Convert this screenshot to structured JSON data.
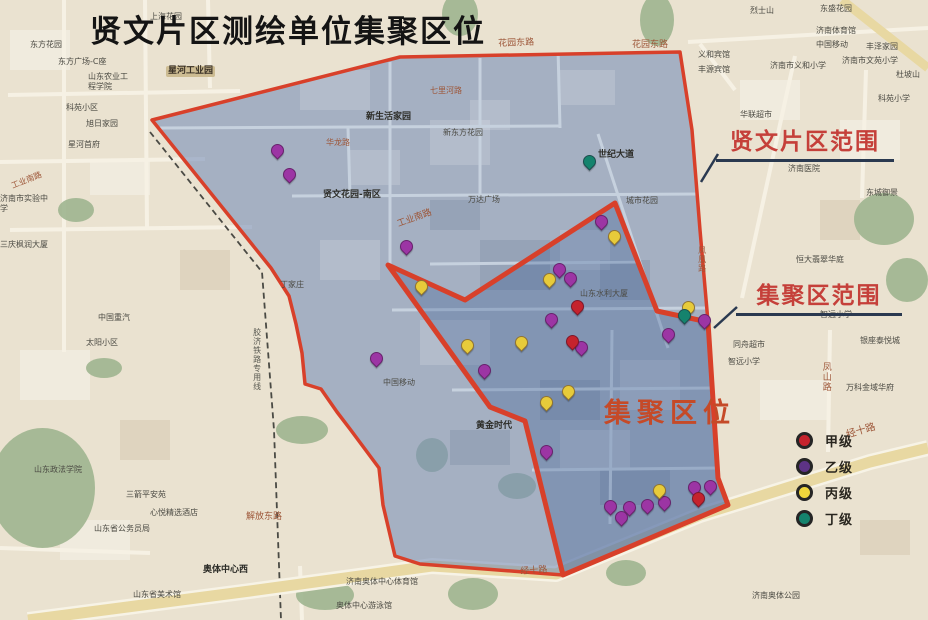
{
  "title": "贤文片区测绘单位集聚区位",
  "callouts": {
    "region": "贤文片区范围",
    "cluster": "集聚区范围",
    "cluster_area": "集聚区位"
  },
  "legend": {
    "items": [
      {
        "label": "甲级",
        "color": "#c5232d"
      },
      {
        "label": "乙级",
        "color": "#5d3385"
      },
      {
        "label": "丙级",
        "color": "#f0d63c"
      },
      {
        "label": "丁级",
        "color": "#15836d"
      }
    ]
  },
  "colors": {
    "beige": "#eae2d0",
    "region_fill": "rgba(115,140,185,0.58)",
    "cluster_fill": "rgba(50,85,145,0.30)",
    "boundary": "#d8402a",
    "pointer": "#2a3950",
    "road_band": "#e8d8a2",
    "road_casing": "#f7f3e6",
    "white_road": "#f6f1e4",
    "inner_road": "#c6d1de",
    "railway": "#4a4a44",
    "park": "#9fb58f",
    "label": "#4b4a43",
    "label_bold": "#2d2d28",
    "label_road": "#9d5638",
    "marker_border": "rgba(40,10,40,0.45)"
  },
  "marker_colors": {
    "甲": "#c5232d",
    "乙": "#9c35a4",
    "丙": "#e7cb3a",
    "丁": "#15836d"
  },
  "map": {
    "outer_polygon": "152,120 400,57 680,52 692,130 700,230 708,322 718,478 728,505 563,575 420,564 395,556 383,505 379,468 350,429 337,412 321,389 305,384 302,353 296,324 289,296 271,268",
    "inner_polygon": "388,265 465,300 615,203 657,311 708,322 718,478 728,505 563,575 525,421 490,407",
    "jingshi_road": "28,620 250,591 432,566 556,574 700,515 870,462 928,448",
    "yellow_road": "842,0 928,68",
    "railway": "150,132 262,272 274,430 281,620",
    "pointers": [
      {
        "x1": 718,
        "y1": 154,
        "x2": 701,
        "y2": 182
      },
      {
        "x1": 737,
        "y1": 307,
        "x2": 714,
        "y2": 328
      }
    ],
    "white_roads": [
      "64,0 64,352",
      "8,95 240,91",
      "0,162 205,159",
      "10,230 252,227",
      "145,0 147,227",
      "208,0 210,88",
      "688,42 928,28",
      "795,56 742,298",
      "830,330 828,452",
      "866,70 862,198",
      "0,548 150,553",
      "300,566 302,620",
      "735,90 700,44"
    ],
    "inner_roads": [
      "160,128 560,126",
      "292,196 700,194",
      "390,62 390,264",
      "480,58 480,195",
      "558,48 560,128",
      "598,134 668,348",
      "392,310 706,308",
      "452,390 716,388",
      "532,470 720,468",
      "612,330 610,524",
      "348,128 350,196",
      "430,264 640,262"
    ],
    "parks": [
      {
        "x": 640,
        "y": -6,
        "w": 34,
        "h": 52
      },
      {
        "x": 854,
        "y": 193,
        "w": 60,
        "h": 52
      },
      {
        "x": 886,
        "y": 258,
        "w": 42,
        "h": 44
      },
      {
        "x": -10,
        "y": 428,
        "w": 105,
        "h": 120
      },
      {
        "x": 86,
        "y": 358,
        "w": 36,
        "h": 20
      },
      {
        "x": 276,
        "y": 416,
        "w": 52,
        "h": 28
      },
      {
        "x": 296,
        "y": 580,
        "w": 58,
        "h": 30
      },
      {
        "x": 448,
        "y": 578,
        "w": 50,
        "h": 32
      },
      {
        "x": 416,
        "y": 438,
        "w": 32,
        "h": 34
      },
      {
        "x": 498,
        "y": 473,
        "w": 38,
        "h": 26
      },
      {
        "x": 442,
        "y": -8,
        "w": 36,
        "h": 44
      },
      {
        "x": 58,
        "y": 198,
        "w": 36,
        "h": 24
      },
      {
        "x": 606,
        "y": 560,
        "w": 40,
        "h": 26
      }
    ],
    "markers": [
      {
        "g": "乙",
        "x": 277,
        "y": 160
      },
      {
        "g": "乙",
        "x": 289,
        "y": 184
      },
      {
        "g": "乙",
        "x": 406,
        "y": 256
      },
      {
        "g": "乙",
        "x": 376,
        "y": 368
      },
      {
        "g": "乙",
        "x": 484,
        "y": 380
      },
      {
        "g": "乙",
        "x": 551,
        "y": 329
      },
      {
        "g": "乙",
        "x": 559,
        "y": 279
      },
      {
        "g": "乙",
        "x": 570,
        "y": 288
      },
      {
        "g": "乙",
        "x": 601,
        "y": 231
      },
      {
        "g": "乙",
        "x": 668,
        "y": 344
      },
      {
        "g": "乙",
        "x": 581,
        "y": 357
      },
      {
        "g": "乙",
        "x": 546,
        "y": 461
      },
      {
        "g": "乙",
        "x": 610,
        "y": 516
      },
      {
        "g": "乙",
        "x": 629,
        "y": 517
      },
      {
        "g": "乙",
        "x": 647,
        "y": 515
      },
      {
        "g": "乙",
        "x": 664,
        "y": 512
      },
      {
        "g": "乙",
        "x": 694,
        "y": 497
      },
      {
        "g": "乙",
        "x": 710,
        "y": 496
      },
      {
        "g": "乙",
        "x": 621,
        "y": 527
      },
      {
        "g": "乙",
        "x": 704,
        "y": 330
      },
      {
        "g": "丙",
        "x": 421,
        "y": 296
      },
      {
        "g": "丙",
        "x": 467,
        "y": 355
      },
      {
        "g": "丙",
        "x": 521,
        "y": 352
      },
      {
        "g": "丙",
        "x": 549,
        "y": 289
      },
      {
        "g": "丙",
        "x": 614,
        "y": 246
      },
      {
        "g": "丙",
        "x": 568,
        "y": 401
      },
      {
        "g": "丙",
        "x": 546,
        "y": 412
      },
      {
        "g": "丙",
        "x": 659,
        "y": 500
      },
      {
        "g": "丙",
        "x": 688,
        "y": 317
      },
      {
        "g": "丁",
        "x": 589,
        "y": 171
      },
      {
        "g": "丁",
        "x": 684,
        "y": 325
      },
      {
        "g": "甲",
        "x": 577,
        "y": 316
      },
      {
        "g": "甲",
        "x": 572,
        "y": 351
      },
      {
        "g": "甲",
        "x": 698,
        "y": 508
      }
    ],
    "labels": [
      {
        "t": "上海花园",
        "x": 150,
        "y": 12
      },
      {
        "t": "东方花园",
        "x": 30,
        "y": 40
      },
      {
        "t": "东方广场-C座",
        "x": 58,
        "y": 57
      },
      {
        "t": "山东农业工程学院",
        "x": 88,
        "y": 72,
        "w": 42
      },
      {
        "t": "科苑小区",
        "x": 66,
        "y": 103
      },
      {
        "t": "旭日家园",
        "x": 86,
        "y": 119
      },
      {
        "t": "星河首府",
        "x": 68,
        "y": 140
      },
      {
        "t": "星河工业园",
        "x": 166,
        "y": 66,
        "hl": 1,
        "s": 9
      },
      {
        "t": "济南市实验中学",
        "x": 0,
        "y": 194,
        "w": 52
      },
      {
        "t": "工业南路",
        "x": 10,
        "y": 182,
        "r": -22,
        "rd": 1
      },
      {
        "t": "三庆枫润大厦",
        "x": 0,
        "y": 240,
        "w": 50
      },
      {
        "t": "中国重汽",
        "x": 98,
        "y": 313
      },
      {
        "t": "太阳小区",
        "x": 86,
        "y": 338
      },
      {
        "t": "山东政法学院",
        "x": 34,
        "y": 465
      },
      {
        "t": "三箭平安苑",
        "x": 126,
        "y": 490
      },
      {
        "t": "心悦精选酒店",
        "x": 150,
        "y": 508
      },
      {
        "t": "山东省公务员局",
        "x": 94,
        "y": 524
      },
      {
        "t": "解放东路",
        "x": 246,
        "y": 512,
        "rd": 1,
        "s": 9
      },
      {
        "t": "奥体中心西",
        "x": 203,
        "y": 565,
        "b": 1,
        "s": 9
      },
      {
        "t": "山东省美术馆",
        "x": 133,
        "y": 590
      },
      {
        "t": "济南奥体中心体育馆",
        "x": 346,
        "y": 577,
        "w": 78
      },
      {
        "t": "奥体中心游泳馆",
        "x": 336,
        "y": 601
      },
      {
        "t": "经十路",
        "x": 520,
        "y": 567,
        "r": -4,
        "rd": 1,
        "s": 9
      },
      {
        "t": "经十路",
        "x": 845,
        "y": 430,
        "r": -16,
        "rd": 1,
        "s": 10
      },
      {
        "t": "丁家庄",
        "x": 280,
        "y": 280
      },
      {
        "t": "烈士山",
        "x": 750,
        "y": 6
      },
      {
        "t": "东盛花园",
        "x": 820,
        "y": 4
      },
      {
        "t": "济南体育馆",
        "x": 816,
        "y": 26
      },
      {
        "t": "中国移动",
        "x": 816,
        "y": 40
      },
      {
        "t": "济南市义和小学",
        "x": 770,
        "y": 61
      },
      {
        "t": "义和宾馆",
        "x": 698,
        "y": 50
      },
      {
        "t": "丰源宾馆",
        "x": 698,
        "y": 65
      },
      {
        "t": "华联超市",
        "x": 740,
        "y": 110
      },
      {
        "t": "丰泽家园",
        "x": 866,
        "y": 42
      },
      {
        "t": "杜坡山",
        "x": 896,
        "y": 70
      },
      {
        "t": "科苑小学",
        "x": 878,
        "y": 94
      },
      {
        "t": "济南市文苑小学",
        "x": 842,
        "y": 56
      },
      {
        "t": "东城御景",
        "x": 866,
        "y": 188
      },
      {
        "t": "济南医院",
        "x": 788,
        "y": 164
      },
      {
        "t": "恒大翡翠华庭",
        "x": 796,
        "y": 255
      },
      {
        "t": "同舟超市",
        "x": 733,
        "y": 340
      },
      {
        "t": "智远小学",
        "x": 820,
        "y": 310
      },
      {
        "t": "智远小学",
        "x": 728,
        "y": 357
      },
      {
        "t": "银座泰悦城",
        "x": 860,
        "y": 336
      },
      {
        "t": "万科金域华府",
        "x": 846,
        "y": 383
      },
      {
        "t": "凤山路",
        "x": 820,
        "y": 362,
        "vt": 1,
        "rd": 1,
        "s": 9
      },
      {
        "t": "凤凰路",
        "x": 697,
        "y": 246,
        "vt": 1,
        "rd": 1
      },
      {
        "t": "花园东路",
        "x": 498,
        "y": 39,
        "rd": 1,
        "s": 9,
        "r": -2
      },
      {
        "t": "花园东路",
        "x": 632,
        "y": 40,
        "rd": 1,
        "s": 9
      },
      {
        "t": "七里河路",
        "x": 430,
        "y": 86,
        "rd": 1
      },
      {
        "t": "新生活家园",
        "x": 366,
        "y": 112,
        "b": 1,
        "s": 9
      },
      {
        "t": "新东方花园",
        "x": 443,
        "y": 128
      },
      {
        "t": "华龙路",
        "x": 326,
        "y": 138,
        "rd": 1
      },
      {
        "t": "世纪大道",
        "x": 598,
        "y": 150,
        "b": 1,
        "s": 9
      },
      {
        "t": "贤文花园-南区",
        "x": 323,
        "y": 190,
        "b": 1,
        "s": 9
      },
      {
        "t": "工业南路",
        "x": 396,
        "y": 220,
        "r": -20,
        "rd": 1,
        "s": 9
      },
      {
        "t": "万达广场",
        "x": 468,
        "y": 195
      },
      {
        "t": "城市花园",
        "x": 626,
        "y": 196
      },
      {
        "t": "中国移动",
        "x": 383,
        "y": 378
      },
      {
        "t": "山东水利大厦",
        "x": 580,
        "y": 289
      },
      {
        "t": "黄金时代",
        "x": 476,
        "y": 421,
        "b": 1,
        "s": 9
      },
      {
        "t": "胶济铁路专用线",
        "x": 252,
        "y": 328,
        "vt": 1,
        "c": "#5a5a52"
      },
      {
        "t": "济南奥体公园",
        "x": 752,
        "y": 591
      }
    ]
  }
}
